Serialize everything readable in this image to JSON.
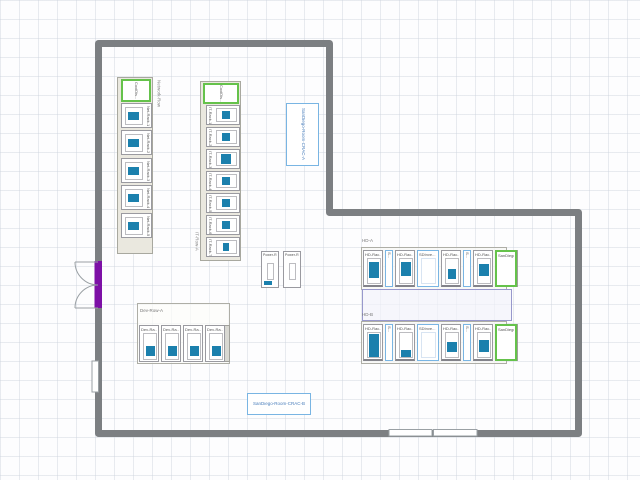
{
  "network_row": {
    "label": "Network-Row",
    "cooling": "CoolDis...",
    "racks": [
      "Net-Rack-1",
      "Net-Rack-2",
      "Net-Rack-3",
      "Net-Rack-4",
      "Net-Rack-5"
    ]
  },
  "it_row": {
    "label": "IT-Row-A",
    "cooling": "CoolDis...",
    "racks": [
      "IT-Rack-1",
      "IT-Rack-2",
      "IT-Rack-3",
      "IT-Rack-4",
      "IT-Rack-5",
      "IT-Rack-6",
      "IT-Rack-7"
    ]
  },
  "crac_a": {
    "label": "SanDiego-Room-CRAC-A"
  },
  "crac_b": {
    "label": "SanDiego-Room-CRAC-B"
  },
  "power_row": {
    "units": [
      "Power-R...",
      "Power-R..."
    ]
  },
  "hd_a": {
    "label": "HD-A",
    "items": [
      {
        "type": "rack",
        "label": "HD-Rac..."
      },
      {
        "type": "sensor",
        "label": "S..."
      },
      {
        "type": "rack",
        "label": "HD-Rac..."
      },
      {
        "type": "panel",
        "label": "SDInve..."
      },
      {
        "type": "rack",
        "label": "HD-Rac..."
      },
      {
        "type": "sensor",
        "label": "S..."
      },
      {
        "type": "rack",
        "label": "HD-Rac..."
      },
      {
        "type": "crac",
        "label": "SanDiego..."
      }
    ]
  },
  "hd_b": {
    "label": "HD-B",
    "items": [
      {
        "type": "rack",
        "label": "HD-Rac..."
      },
      {
        "type": "sensor",
        "label": "S..."
      },
      {
        "type": "rack",
        "label": "HD-Rac..."
      },
      {
        "type": "panel",
        "label": "SDInve..."
      },
      {
        "type": "rack",
        "label": "HD-Rac..."
      },
      {
        "type": "sensor",
        "label": "S..."
      },
      {
        "type": "rack",
        "label": "HD-Rac..."
      },
      {
        "type": "crac",
        "label": "SanDiego..."
      }
    ]
  },
  "dev_row": {
    "label": "Dev-Row-A",
    "racks": [
      "Dev-Ra...",
      "Dev-Ra...",
      "Dev-Ra...",
      "Dev-Ra..."
    ]
  },
  "colors": {
    "device_teal": "#1b80ad",
    "cooling_green": "#65c24b",
    "crac_blue": "#79b5e3",
    "wall_gray": "#7c7f82",
    "door_purple": "#7d10a6",
    "aisle_lavender": "#9898cc"
  }
}
